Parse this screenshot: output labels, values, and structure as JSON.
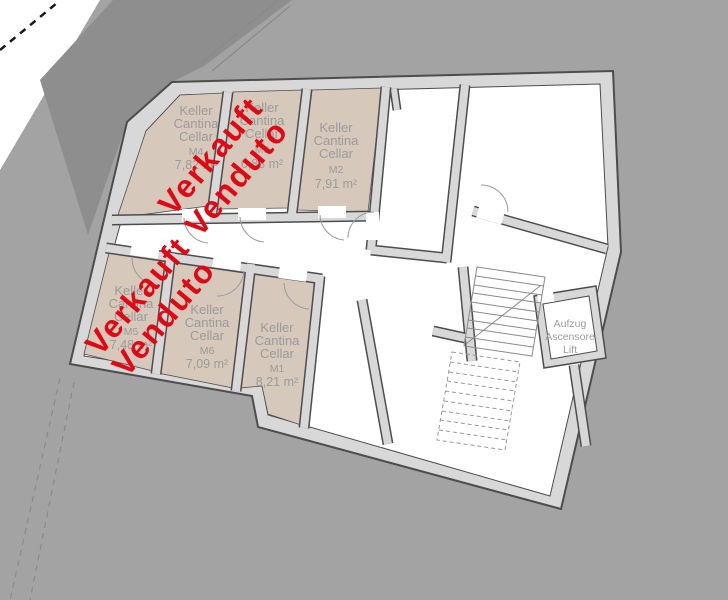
{
  "plan": {
    "type": "basement floor plan",
    "room_label_lines": [
      "Keller",
      "Cantina",
      "Cellar"
    ],
    "rooms": [
      {
        "code": "M4",
        "area": "7,82 m²",
        "sold": true
      },
      {
        "code": "M3",
        "area": "6,83 m²",
        "sold": false
      },
      {
        "code": "M2",
        "area": "7,91 m²",
        "sold": false
      },
      {
        "code": "M5",
        "area": "7,48 m²",
        "sold": true
      },
      {
        "code": "M6",
        "area": "7,09 m²",
        "sold": false
      },
      {
        "code": "M1",
        "area": "8,21 m²",
        "sold": false
      }
    ],
    "sold_overlay": {
      "line1": "Verkauft",
      "line2": "Venduto",
      "color": "#e30613"
    },
    "elevator": {
      "line1": "Aufzug",
      "line2": "Ascensore",
      "line3": "Lift"
    },
    "colors": {
      "ground": "#a3a3a3",
      "ground_dark": "#8e8e8e",
      "wall_fill": "#d8d8d8",
      "wall_line": "#4d4d4d",
      "cellar_room_fill": "#d6c8ba",
      "interior_fill": "#ffffff",
      "label_text": "#9b9b9b",
      "sold_text": "#e30613"
    }
  }
}
